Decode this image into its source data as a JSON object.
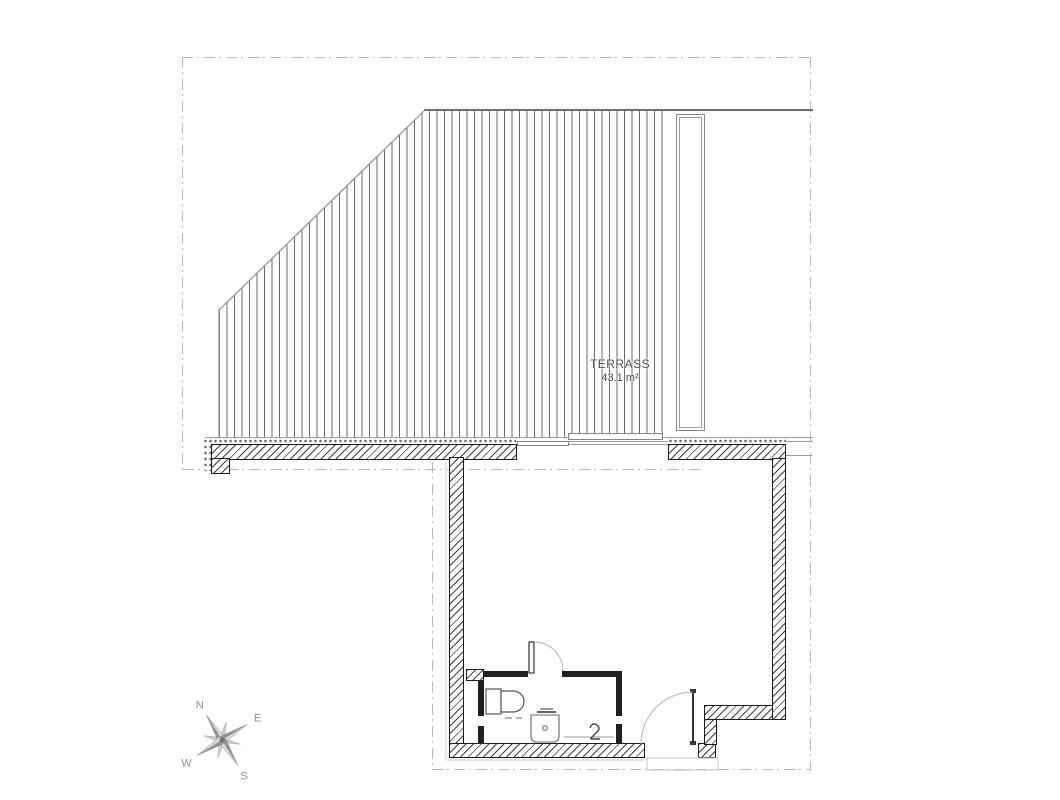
{
  "terrace": {
    "label": "TERRASS",
    "area": "43.1 m²"
  },
  "compass": {
    "north": "N",
    "east": "E",
    "south": "S",
    "west": "W"
  },
  "colors": {
    "wall_hatch": "#3d3d3d",
    "wall_outline": "#1c1c1c",
    "terrace_hatch": "#6a6a6a",
    "boundary_dashdot": "#b7babc",
    "label_text": "#4d4d4d",
    "compass_dark": "#8f9294",
    "compass_light": "#d8dadb"
  }
}
